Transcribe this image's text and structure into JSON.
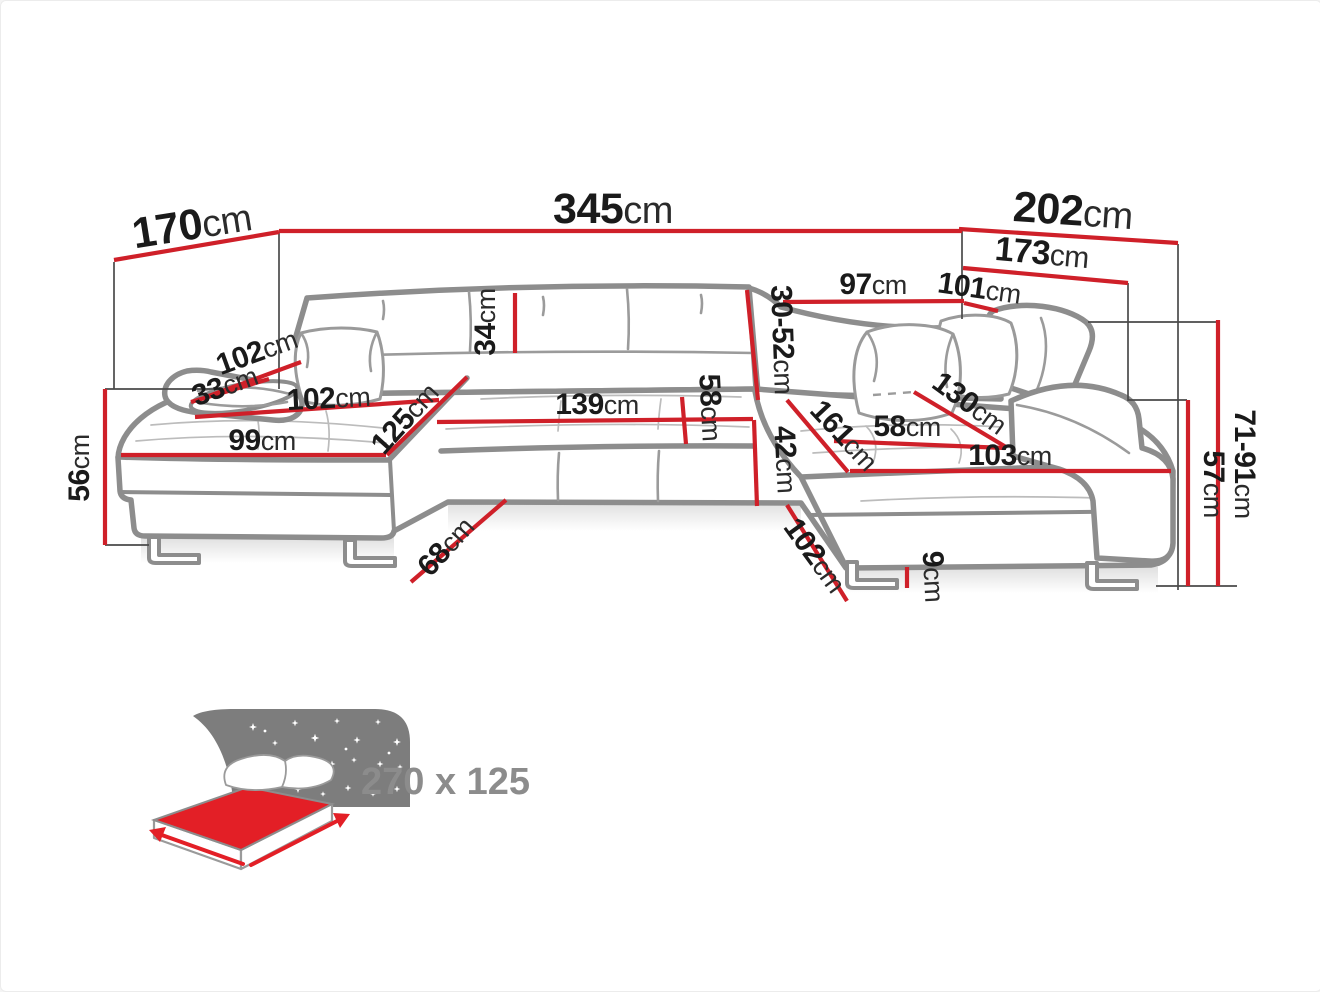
{
  "palette": {
    "bg": "#ffffff",
    "dim_red": "#cf2029",
    "art_gray": "#8d8d8d",
    "text_black": "#1a1a1a",
    "icon_gray": "#7d7d7d",
    "icon_red": "#e31f26",
    "icon_text_gray": "#8c8c8c"
  },
  "diagram": {
    "dimensions": {
      "left_depth": {
        "value": "170",
        "unit": "cm"
      },
      "total_width": {
        "value": "345",
        "unit": "cm"
      },
      "right_depth": {
        "value": "202",
        "unit": "cm"
      },
      "right_inner_depth": {
        "value": "173",
        "unit": "cm"
      },
      "right_seat_span": {
        "value": "97",
        "unit": "cm"
      },
      "right_headrest_span": {
        "value": "101",
        "unit": "cm"
      },
      "backrest_cushion_height": {
        "value": "34",
        "unit": "cm"
      },
      "headrest_height_range": {
        "value": "30-52",
        "unit": "cm"
      },
      "left_arm_length": {
        "value": "102",
        "unit": "cm"
      },
      "left_arm_width": {
        "value": "33",
        "unit": "cm"
      },
      "chaise_top_length": {
        "value": "102",
        "unit": "cm"
      },
      "chaise_front_width": {
        "value": "99",
        "unit": "cm"
      },
      "chaise_side_depth": {
        "value": "125",
        "unit": "cm"
      },
      "bench_seat_width": {
        "value": "139",
        "unit": "cm"
      },
      "bench_seat_depth": {
        "value": "58",
        "unit": "cm"
      },
      "seat_front_height": {
        "value": "42",
        "unit": "cm"
      },
      "right_seat_diagonal": {
        "value": "161",
        "unit": "cm"
      },
      "right_seat_depth": {
        "value": "58",
        "unit": "cm"
      },
      "right_chaise_length": {
        "value": "130",
        "unit": "cm"
      },
      "right_chaise_width": {
        "value": "103",
        "unit": "cm"
      },
      "left_side_height": {
        "value": "56",
        "unit": "cm"
      },
      "bench_front_depth": {
        "value": "68",
        "unit": "cm"
      },
      "right_front_depth": {
        "value": "102",
        "unit": "cm"
      },
      "foot_height": {
        "value": "9",
        "unit": "cm"
      },
      "backrest_height_range": {
        "value": "71-91",
        "unit": "cm"
      },
      "right_arm_height": {
        "value": "57",
        "unit": "cm"
      }
    },
    "sleeping_area_label": "270 x 125"
  }
}
